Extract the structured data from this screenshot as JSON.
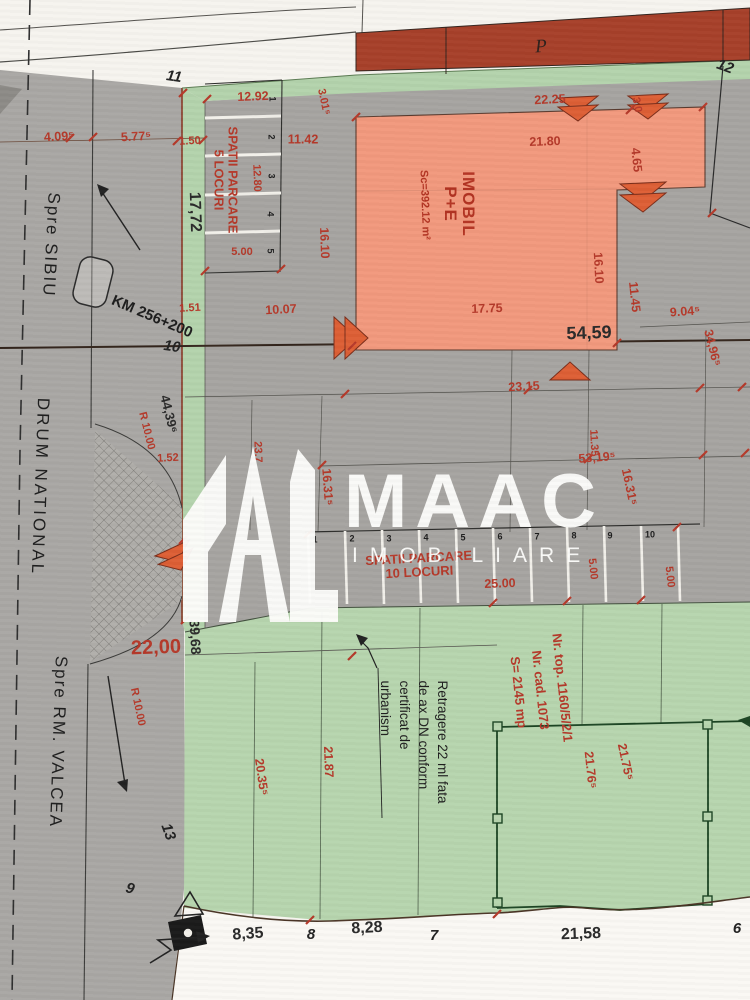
{
  "watermark": {
    "brand": "MAAC",
    "subtitle": "IMOBILIARE"
  },
  "roads": {
    "sibiu": "Spre SIBIU",
    "national": "DRUM NATIONAL",
    "valcea": "Spre RM. VALCEA",
    "km": "KM 256+200"
  },
  "buildings": {
    "imobil_line1": "IMOBIL",
    "imobil_line2": "P+E",
    "imobil_area": "Sc=392.12 m²",
    "neighbor_label": "P"
  },
  "parking_top": {
    "line1": "SPATII PARCARE",
    "line2": "5 LOCURI",
    "stalls": [
      "1",
      "2",
      "3",
      "4",
      "5"
    ]
  },
  "parking_bottom": {
    "line1": "SPATII PARCARE",
    "line2": "10 LOCURI",
    "stalls": [
      "1",
      "2",
      "3",
      "4",
      "5",
      "6",
      "7",
      "8",
      "9",
      "10"
    ]
  },
  "cadastral": {
    "line1": "Nr. top. 1160/5/2/1",
    "line2": "Nr. cad. 1073",
    "line3": "S= 2145 mp"
  },
  "setback": {
    "line1": "Retragere 22 ml fata",
    "line2": "de ax DN conform",
    "line3": "certificat de",
    "line4": "urbanism"
  },
  "points": {
    "p6": "6",
    "p7": "7",
    "p8": "8",
    "p9": "9",
    "p10": "10",
    "p11": "11",
    "p12": "12",
    "p13": "13"
  },
  "dims": {
    "d4_09": "4.09⁵",
    "d5_77": "5.77⁵",
    "d1_50": "1.50",
    "d1_51": "1.51",
    "d12_92": "12.92",
    "d11_42": "11.42",
    "d12_80": "12.80",
    "d5_00": "5.00",
    "d3_01": "3.01⁵",
    "d16_10": "16.10",
    "d17_72": "17,72",
    "d22_25": "22.25",
    "d3_0": "3.0",
    "d21_80": "21.80",
    "d4_65": "4.65",
    "d16_10b": "16.10",
    "d11_45": "11.45",
    "d9_04": "9.04⁵",
    "d34_96": "34,96⁵",
    "d10_07": "10.07",
    "d17_75": "17.75",
    "d54_59": "54,59",
    "d23_15": "23.15",
    "d44_39": "44,39⁶",
    "dR10": "R 10.00",
    "dR10b": "R 10.00",
    "d1_52": "1.52",
    "d23_7": "23.7",
    "d16_31a": "16.31⁵",
    "d16_31b": "16.31⁵",
    "d11_35": "11.35",
    "d53_19": "53,19⁵",
    "d25_00": "25.00",
    "d5_00b": "5.00",
    "d5_00c": "5.00",
    "d22_00": "22,00",
    "d39_68": "39,68",
    "d20_35": "20.35⁵",
    "d21_87": "21.87",
    "d21_76": "21.76⁵",
    "d21_75": "21.75⁵",
    "d8_35": "8,35",
    "d8_28": "8,28",
    "d21_58": "21,58"
  },
  "colors": {
    "dim_red": "#b5392a",
    "building_fill": "#f2997d",
    "bar_red": "#a7402a",
    "green": "#b7d5ae",
    "road_gray": "#a9a7a4",
    "plot_gray": "#a6a4a1",
    "footprint_green": "#1c4423",
    "paper": "#f6f4ef"
  }
}
